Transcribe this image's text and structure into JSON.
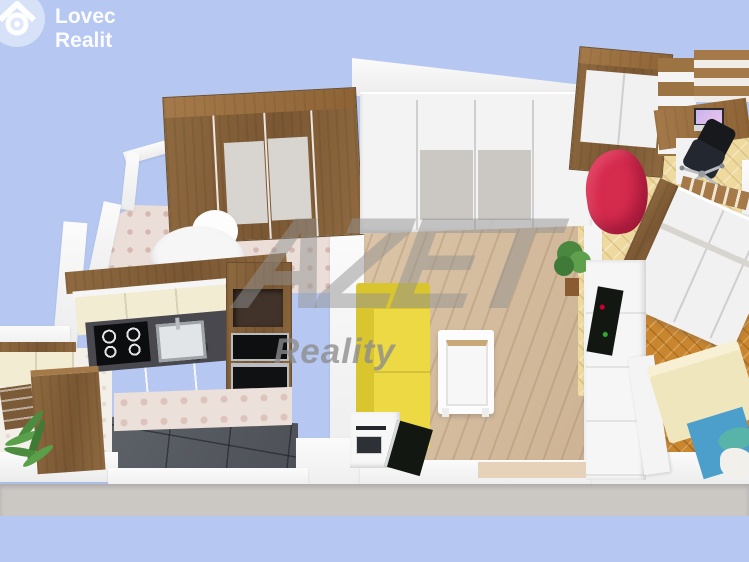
{
  "brand": {
    "line1": "Lovec",
    "line2": "Realit",
    "icon": "house-scope-icon"
  },
  "watermark": {
    "line1": "AZET",
    "line2": "Reality"
  },
  "colors": {
    "sky": "#b6c8f1",
    "slab": "#cbc8c4",
    "wall": "#f6f6f6",
    "sofa": "#ecd944",
    "sofa_back": "#d9c52e",
    "beanbag": "#d52b4d",
    "wood": "#8a6640",
    "wood_light": "#a57a4a",
    "cream_cabinet": "#f2ecd2",
    "counter_dark": "#48484e",
    "tile_dark": "#585c62",
    "plank_floor": "#d8c1a4",
    "parquet_light": "#eeda9f",
    "parquet_orange": "#c9862f",
    "pattern_pink_floor": "#ebded8",
    "bed_cream": "#efe6bd",
    "bed_blue": "#4c9fcb",
    "pillow_teal": "#58b4a8",
    "tv_black": "#131711",
    "grey_panel": "#cbc7c3"
  },
  "scene": {
    "type": "3d-floorplan-render",
    "rooms": [
      {
        "name": "Bedroom (top left)",
        "floor": "pink patterned tile"
      },
      {
        "name": "Kitchen",
        "floor": "dark stone tile"
      },
      {
        "name": "Dining nook",
        "floor": "light patterned tile"
      },
      {
        "name": "Living room",
        "floor": "light wood planks"
      },
      {
        "name": "Study room",
        "floor": "light herringbone parquet"
      },
      {
        "name": "Bedroom (right)",
        "floor": "orange herringbone parquet"
      }
    ],
    "furniture": [
      "wooden wardrobe",
      "white armchair",
      "round side table",
      "white sliding wardrobe",
      "yellow corner sofa",
      "white coffee table",
      "tv cabinet",
      "flat tv",
      "potted plant",
      "kitchen cabinets",
      "gas cooktop",
      "steel sink",
      "oven column",
      "dining table",
      "wooden chair",
      "fern plant",
      "study wardrobe",
      "bookshelf column",
      "desk",
      "laptop",
      "office chair",
      "red bean bag",
      "loft bed",
      "bedroom wardrobe",
      "white tv wall unit",
      "double bed"
    ]
  }
}
